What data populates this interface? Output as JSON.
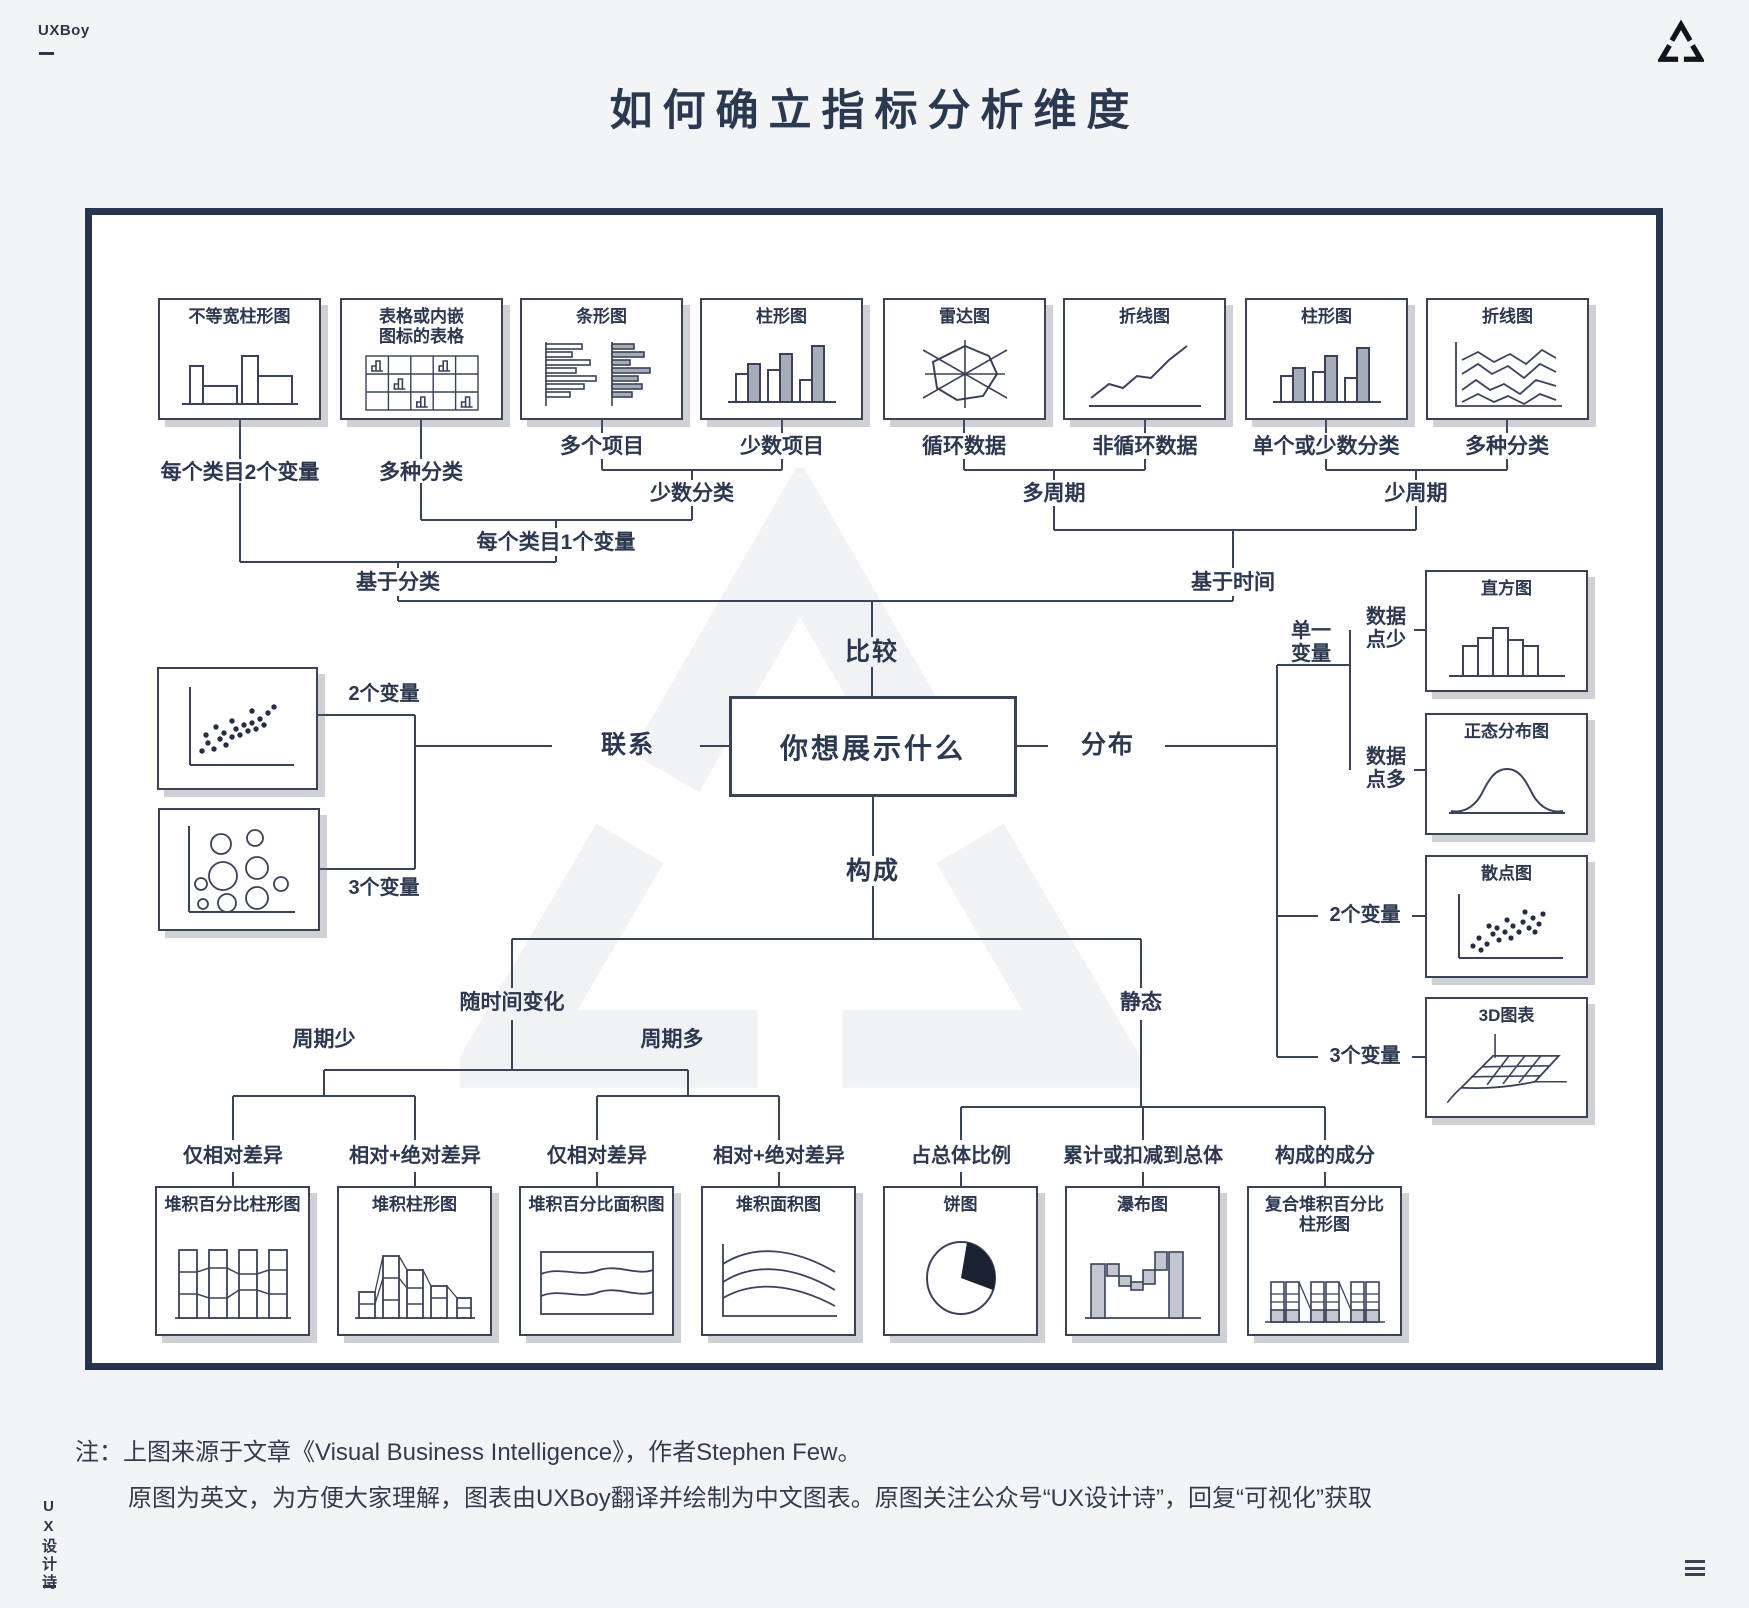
{
  "colors": {
    "ink": "#2c3750",
    "line": "#3a4459",
    "page_bg": "#f3f4f7",
    "frame_border": "#263450",
    "gray_fill": "#a6acb8",
    "pie_fill": "#1a2130",
    "watermark": "#f1f3f7"
  },
  "header": {
    "brand": "UXBoy",
    "title": "如何确立指标分析维度",
    "logo_icon": "triangle-logo"
  },
  "side": {
    "vertical_brand": "UX设计诗"
  },
  "note": {
    "line1": "注：上图来源于文章《Visual Business Intelligence》，作者Stephen Few。",
    "line2": "原图为英文，为方便大家理解，图表由UXBoy翻译并绘制为中文图表。原图关注公众号“UX设计诗”，回复“可视化”获取"
  },
  "flow": {
    "question": "你想展示什么",
    "compare": "比较",
    "relation": "联系",
    "distribution": "分布",
    "composition": "构成",
    "top_charts": [
      {
        "title": "不等宽柱形图",
        "label": "每个类目2个变量"
      },
      {
        "title": "表格或内嵌图标的表格",
        "label": "多种分类"
      },
      {
        "title": "条形图",
        "label": "多个项目"
      },
      {
        "title": "柱形图",
        "label": "少数项目"
      },
      {
        "title": "雷达图",
        "label": "循环数据"
      },
      {
        "title": "折线图",
        "label": "非循环数据"
      },
      {
        "title": "柱形图",
        "label": "单个或少数分类"
      },
      {
        "title": "折线图",
        "label": "多种分类"
      }
    ],
    "top_merges": {
      "few_categories": "少数分类",
      "one_variable_per_category": "每个类目1个变量",
      "by_category": "基于分类",
      "many_periods": "多周期",
      "few_periods": "少周期",
      "by_time": "基于时间"
    },
    "relation_branch": {
      "two_variables": "2个变量",
      "three_variables": "3个变量"
    },
    "distribution_branch": {
      "single_variable": "单一变量",
      "few_data_points": "数据点少",
      "many_data_points": "数据点多",
      "two_variables": "2个变量",
      "three_variables": "3个变量",
      "charts": [
        {
          "title": "直方图"
        },
        {
          "title": "正态分布图"
        },
        {
          "title": "散点图"
        },
        {
          "title": "3D图表"
        }
      ]
    },
    "composition_branch": {
      "changing_over_time": "随时间变化",
      "static": "静态",
      "few_periods": "周期少",
      "many_periods": "周期多",
      "leaves": [
        {
          "label": "仅相对差异",
          "title": "堆积百分比柱形图"
        },
        {
          "label": "相对+绝对差异",
          "title": "堆积柱形图"
        },
        {
          "label": "仅相对差异",
          "title": "堆积百分比面积图"
        },
        {
          "label": "相对+绝对差异",
          "title": "堆积面积图"
        },
        {
          "label": "占总体比例",
          "title": "饼图"
        },
        {
          "label": "累计或扣减到总体",
          "title": "瀑布图"
        },
        {
          "label": "构成的成分",
          "title": "复合堆积百分比柱形图"
        }
      ]
    }
  }
}
